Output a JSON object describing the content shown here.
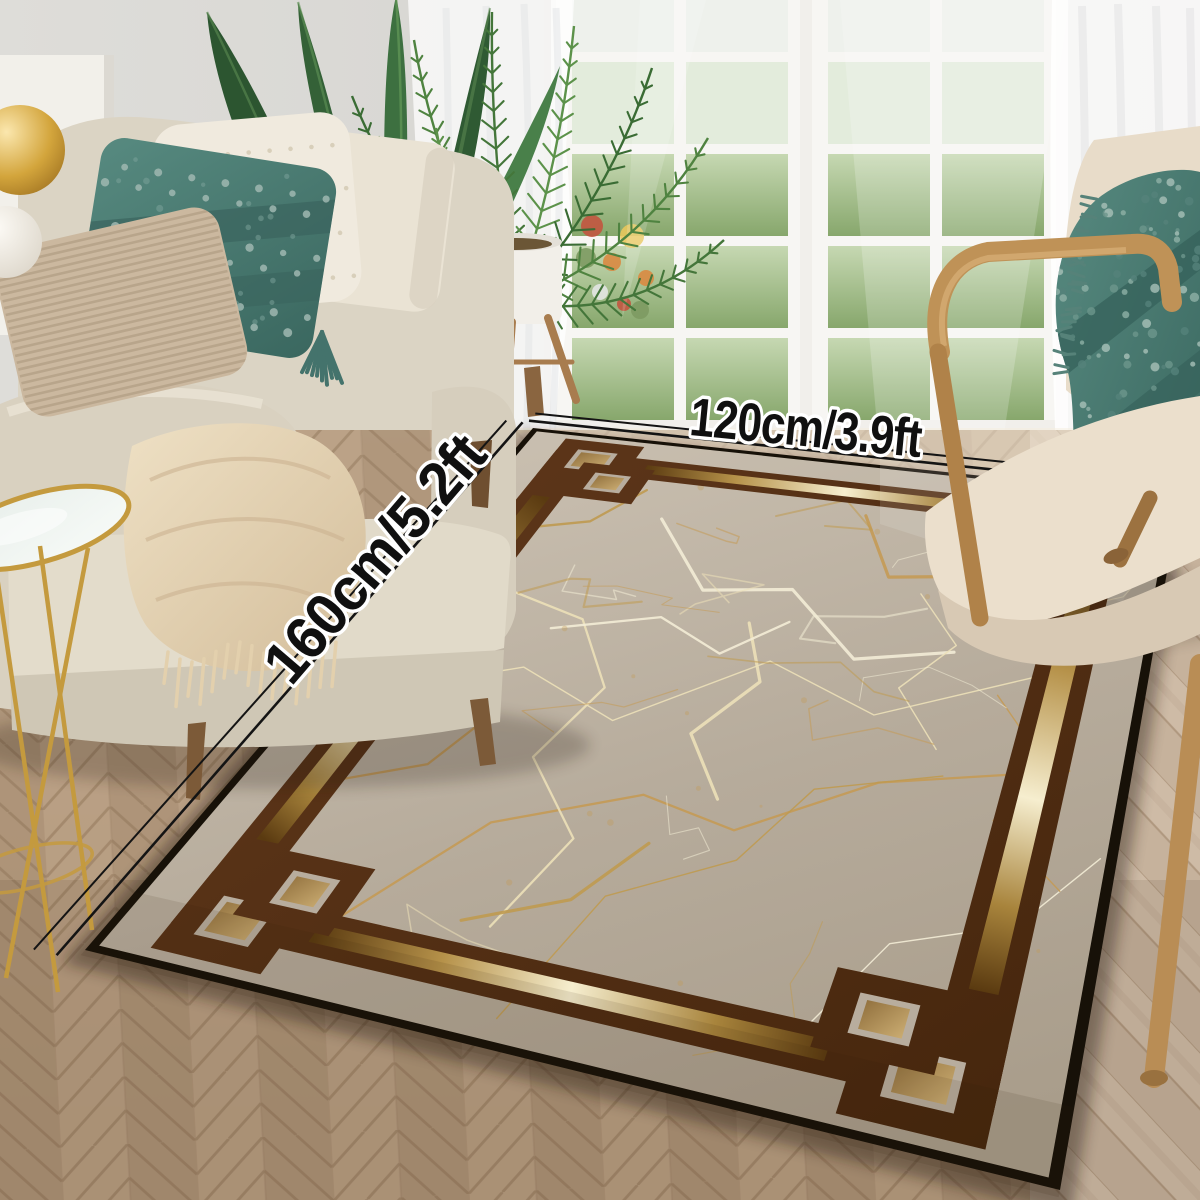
{
  "photo": {
    "type": "rug-product-photo",
    "width_label": "120cm/3.9ft",
    "height_label": "160cm/5.2ft"
  },
  "colors": {
    "rug_field": "#b8ad9e",
    "rug_margin": "#c2b8a9",
    "rug_outline": "#171108",
    "rug_border_brown": "#4d2b13",
    "rug_gold_bright": "#f6eecf",
    "rug_gold_mid": "#b6924a",
    "rug_gold_dark": "#5a3a10",
    "rug_vein_gold": "#c49a55",
    "rug_vein_pale": "#ece0b8",
    "rug_corner_tan": "#b3905c",
    "label_text": "#101010",
    "label_outline": "#ffffff",
    "floor_herringbone": "#b49a7e",
    "floor_plank": "#c6b29c",
    "wall": "#d5d4d0",
    "sofa_fabric": "#dbd4c4",
    "pillow_teal": "#476e6c",
    "pillow_beige": "#cbb89f",
    "throw_cream": "#e8d9bc",
    "chair_wood": "#bf9257",
    "chair_cushion": "#e9ddca",
    "curtain_white": "#ffffff",
    "lawn_green": "#9ab983",
    "plant_green": "#3a6c34",
    "table_gold": "#c49a3e"
  }
}
